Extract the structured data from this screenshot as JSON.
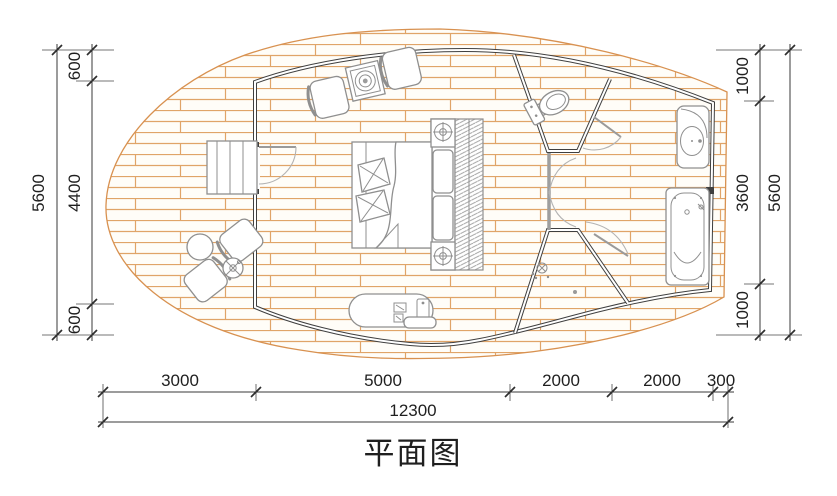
{
  "drawing": {
    "title": "平面图",
    "dimensions": {
      "left": {
        "total": "5600",
        "segments": [
          "600",
          "4400",
          "600"
        ]
      },
      "right": {
        "total": "5600",
        "segments": [
          "1000",
          "3600",
          "1000"
        ]
      },
      "bottom": {
        "total": "12300",
        "segments": [
          "3000",
          "5000",
          "2000",
          "2000",
          "300"
        ]
      }
    },
    "colors": {
      "wall": "#3f3f3f",
      "brick_line": "#e0a468",
      "deck_edge": "#d89150",
      "furniture": "#8f8f8f",
      "dimension": "#3a3a3a",
      "text": "#1f1f1f"
    },
    "elements": {
      "deck": "wood-deck",
      "pod": "pod-cabin-outline",
      "entry": "entry-steps-and-door",
      "bedroom": [
        "lounge-chair",
        "side-table",
        "lounge-chair",
        "double-bed",
        "nightstand-lamp",
        "headboard-panels",
        "nightstand-lamp",
        "wardrobe-hangers",
        "tv-bench"
      ],
      "bathroom": [
        "toilet",
        "shower-room",
        "vanity-sink",
        "bathtub"
      ],
      "outdoor": [
        "armchair",
        "round-table",
        "flower-stool",
        "armchair"
      ]
    }
  }
}
